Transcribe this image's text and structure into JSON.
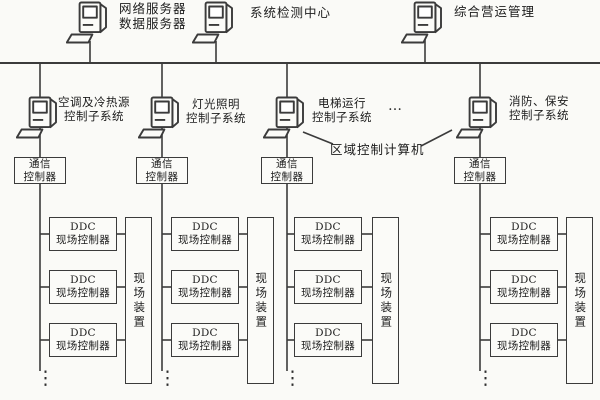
{
  "diagram_type": "building-automation-system-architecture",
  "colors": {
    "background": "#fafaf7",
    "line": "#3b3b3b",
    "text": "#1c1c1c",
    "box_fill": "#fbfbf8"
  },
  "management_level": {
    "nodes": [
      {
        "label": "网络服务器\n数据服务器"
      },
      {
        "label": "系统检测中心"
      },
      {
        "label": "综合营运管理"
      }
    ]
  },
  "control_level": {
    "subsystems": [
      {
        "label": "空调及冷热源\n控制子系统"
      },
      {
        "label": "灯光照明\n控制子系统"
      },
      {
        "label": "电梯运行\n控制子系统"
      },
      {
        "label": "消防、保安\n控制子系统"
      }
    ],
    "more_subsystems_ellipsis": "…",
    "area_computer_label": "区域控制计算机",
    "comm_controller_label": "通信\n控制器"
  },
  "field_level": {
    "ddc_controller_label": "DDC\n现场控制器",
    "field_device_label": "现场装置",
    "continuation_ellipsis": "⋮"
  }
}
